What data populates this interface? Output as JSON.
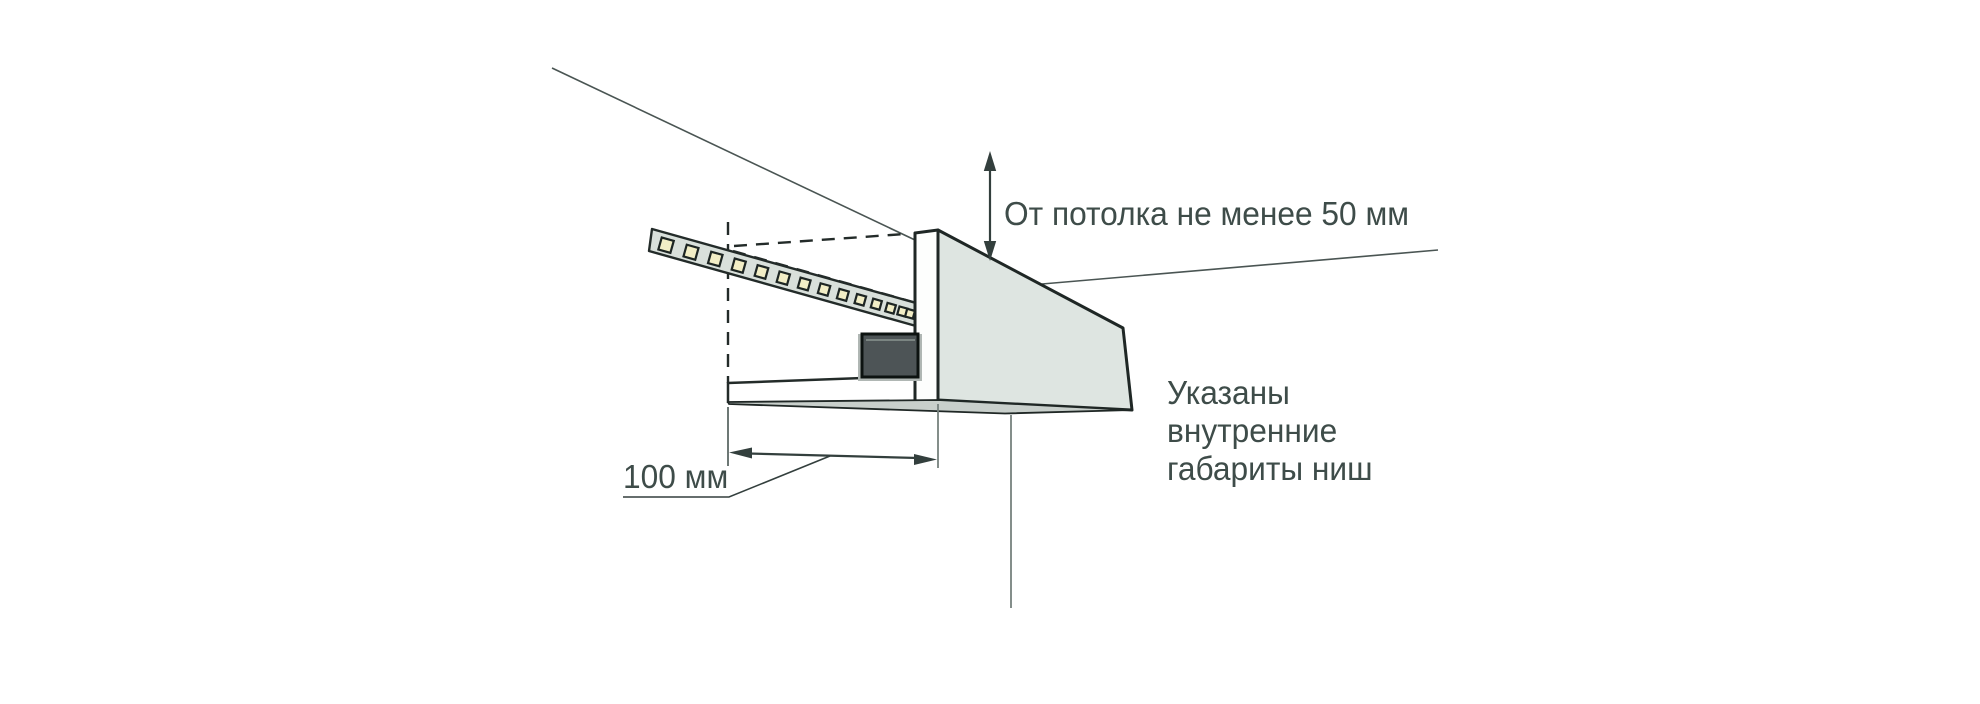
{
  "page": {
    "background": "#ffffff",
    "kind_note": "Technical installation diagram of a ceiling light niche"
  },
  "colors": {
    "background": "#ffffff",
    "outline": "#1f2725",
    "line_thin": "#4a5553",
    "line_dashed": "#232b29",
    "text": "#3e4c49",
    "dim": "#333f3d",
    "wall": "#fdfefd",
    "face": "#dee5e1",
    "wedge": "#c8cfcb",
    "strip": "#d9e0db",
    "led": "#f2eec6",
    "driver": "#4d5456",
    "driver_frame": "#b0b7b4"
  },
  "diagram": {
    "labels": {
      "ceiling_clearance": "От потолка не менее 50 мм",
      "niche_note": "Указаны\nвнутренние\nгабариты ниш",
      "width_dimension": "100 мм"
    },
    "led_strip": {
      "count": 14
    }
  }
}
